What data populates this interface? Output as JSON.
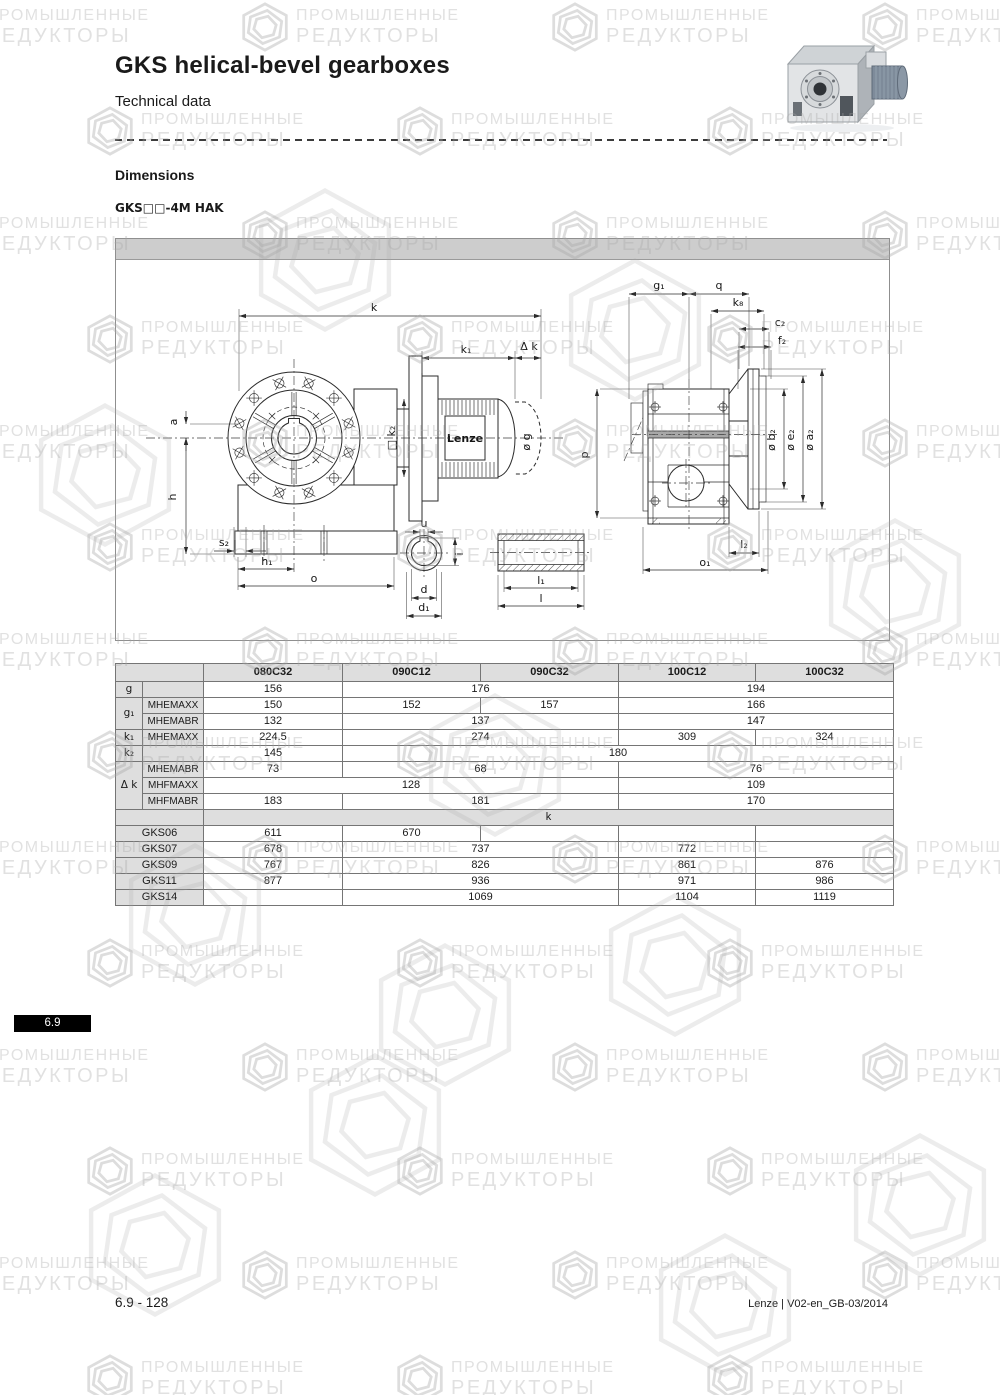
{
  "page": {
    "title": "GKS helical-bevel gearboxes",
    "subtitle": "Technical data",
    "section_heading": "Dimensions",
    "variant_label": "GKS□□-4M HAK",
    "tab_number": "6.9",
    "footer_left": "6.9 - 128",
    "footer_right": "Lenze | V02-en_GB-03/2014"
  },
  "watermark": {
    "line1": "ПРОМЫШЛЕННЫЕ",
    "line2": "РЕДУКТОРЫ"
  },
  "drawing": {
    "labels": {
      "k": "k",
      "k1": "k₁",
      "dk": "Δ k",
      "k2": "□ k₂",
      "a": "a",
      "h": "h",
      "s2": "s₂",
      "h1": "h₁",
      "o": "o",
      "u": "u",
      "i": "i",
      "d": "d",
      "d1": "d₁",
      "l1": "l₁",
      "l": "l",
      "g1": "g₁",
      "q": "q",
      "k8": "k₈",
      "c2": "c₂",
      "f2": "f₂",
      "p": "p",
      "b2": "ø b₂",
      "e2": "ø e₂",
      "a2": "ø a₂",
      "l2": "l₂",
      "o1": "o₁",
      "brand": "Lenze",
      "g": "ø g"
    }
  },
  "table": {
    "col_headers": [
      "080C32",
      "090C12",
      "090C32",
      "100C12",
      "100C32"
    ],
    "rows": [
      {
        "label": "g",
        "sublabel": "",
        "values": [
          "156",
          "176",
          "194"
        ]
      },
      {
        "label": "g₁",
        "sublabel": "MHEMAXX",
        "values": [
          "150",
          "152",
          "157",
          "166"
        ]
      },
      {
        "label": "",
        "sublabel": "MHEMABR",
        "values": [
          "132",
          "137",
          "147"
        ]
      },
      {
        "label": "k₁",
        "sublabel": "MHEMAXX",
        "values": [
          "224.5",
          "274",
          "309",
          "324"
        ]
      },
      {
        "label": "k₂",
        "sublabel": "",
        "values": [
          "145",
          "180"
        ]
      },
      {
        "label": "Δ k",
        "sublabel": "MHEMABR",
        "values": [
          "73",
          "68",
          "76"
        ]
      },
      {
        "label": "",
        "sublabel": "MHFMAXX",
        "values": [
          "128",
          "109"
        ]
      },
      {
        "label": "",
        "sublabel": "MHFMABR",
        "values": [
          "183",
          "181",
          "170"
        ]
      }
    ],
    "section_label": "k",
    "gks": [
      {
        "label": "GKS06",
        "values": [
          "611",
          "670",
          "",
          "",
          ""
        ]
      },
      {
        "label": "GKS07",
        "values": [
          "678",
          "737",
          "772",
          ""
        ]
      },
      {
        "label": "GKS09",
        "values": [
          "767",
          "826",
          "861",
          "876"
        ]
      },
      {
        "label": "GKS11",
        "values": [
          "877",
          "936",
          "971",
          "986"
        ]
      },
      {
        "label": "GKS14",
        "values": [
          "",
          "1069",
          "1104",
          "1119"
        ]
      }
    ]
  }
}
